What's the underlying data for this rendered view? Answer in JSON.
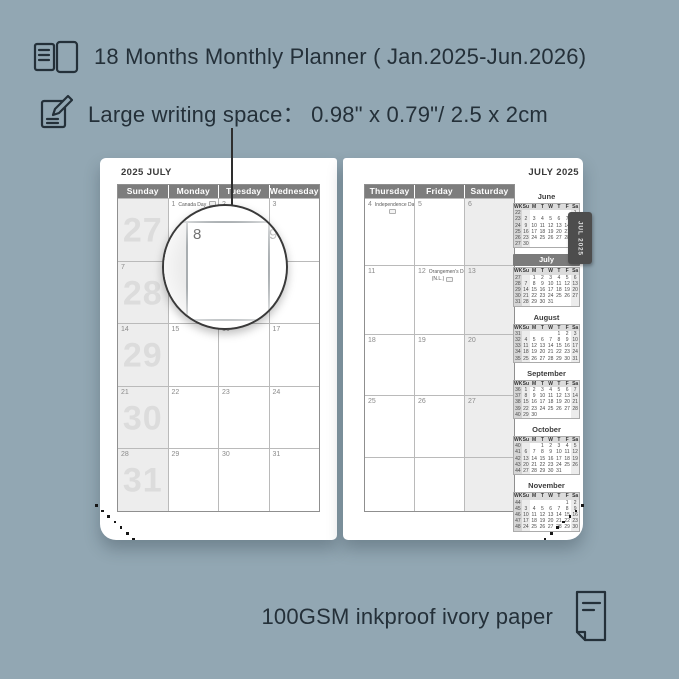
{
  "background_color": "#92a7b3",
  "text_color": "#243039",
  "accent_gray": "#7d7d7d",
  "features": {
    "months_line": "18 Months Monthly Planner ( Jan.2025-Jun.2026)",
    "writing_line": "Large writing space：  0.98\" x 0.79\"/ 2.5 x 2cm",
    "paper_line": "100GSM inkproof ivory paper"
  },
  "icons": {
    "months": "open-book-icon",
    "writing": "pencil-note-icon",
    "paper": "paper-sheet-icon"
  },
  "magnifier": {
    "cell_day": "8",
    "adjacent_day": "9"
  },
  "spread": {
    "left_page": {
      "title": "2025 JULY",
      "day_headers": [
        "Sunday",
        "Monday",
        "Tuesday",
        "Wednesday"
      ],
      "weeks": [
        {
          "week_number": "27",
          "cells": [
            {
              "date": ""
            },
            {
              "date": "1",
              "holiday": "Canada Day",
              "flag_line": 1
            },
            {
              "date": "2"
            },
            {
              "date": "3"
            }
          ]
        },
        {
          "week_number": "28",
          "cells": [
            {
              "date": "7"
            },
            {
              "date": "8"
            },
            {
              "date": "9"
            },
            {
              "date": "10"
            }
          ]
        },
        {
          "week_number": "29",
          "cells": [
            {
              "date": "14"
            },
            {
              "date": "15"
            },
            {
              "date": "16"
            },
            {
              "date": "17"
            }
          ]
        },
        {
          "week_number": "30",
          "cells": [
            {
              "date": "21"
            },
            {
              "date": "22"
            },
            {
              "date": "23"
            },
            {
              "date": "24"
            }
          ]
        },
        {
          "week_number": "31",
          "cells": [
            {
              "date": "28"
            },
            {
              "date": "29"
            },
            {
              "date": "30"
            },
            {
              "date": "31"
            }
          ]
        }
      ]
    },
    "right_page": {
      "title": "JULY 2025",
      "tab_label": "JUL 2025",
      "day_headers": [
        "Thursday",
        "Friday",
        "Saturday"
      ],
      "weeks": [
        {
          "cells": [
            {
              "date": "4",
              "holiday": "Independence Day",
              "holiday_line2": "",
              "flag_line": 2
            },
            {
              "date": "5"
            },
            {
              "date": "6"
            }
          ]
        },
        {
          "cells": [
            {
              "date": "11"
            },
            {
              "date": "12",
              "holiday": "Orangemen's Day",
              "holiday_line2": "(N.L.)",
              "flag_line": 2
            },
            {
              "date": "13"
            }
          ]
        },
        {
          "cells": [
            {
              "date": "18"
            },
            {
              "date": "19"
            },
            {
              "date": "20"
            }
          ]
        },
        {
          "cells": [
            {
              "date": "25"
            },
            {
              "date": "26"
            },
            {
              "date": "27"
            }
          ]
        },
        {
          "cells": [
            {
              "date": ""
            },
            {
              "date": ""
            },
            {
              "date": ""
            }
          ]
        }
      ]
    },
    "mini_calendars": {
      "weekday_header": [
        "WK",
        "Su",
        "M",
        "T",
        "W",
        "T",
        "F",
        "Sa"
      ],
      "months": [
        {
          "name": "June",
          "highlighted": false,
          "rows": [
            [
              "22",
              "",
              "",
              "",
              "",
              "",
              "",
              "1"
            ],
            [
              "23",
              "2",
              "3",
              "4",
              "5",
              "6",
              "7",
              "8"
            ],
            [
              "24",
              "9",
              "10",
              "11",
              "12",
              "13",
              "14",
              "15"
            ],
            [
              "25",
              "16",
              "17",
              "18",
              "19",
              "20",
              "21",
              "22"
            ],
            [
              "26",
              "23",
              "24",
              "25",
              "26",
              "27",
              "28",
              "29"
            ],
            [
              "27",
              "30",
              "",
              "",
              "",
              "",
              "",
              ""
            ]
          ]
        },
        {
          "name": "July",
          "highlighted": true,
          "rows": [
            [
              "27",
              "",
              "1",
              "2",
              "3",
              "4",
              "5",
              "6"
            ],
            [
              "28",
              "7",
              "8",
              "9",
              "10",
              "11",
              "12",
              "13"
            ],
            [
              "29",
              "14",
              "15",
              "16",
              "17",
              "18",
              "19",
              "20"
            ],
            [
              "30",
              "21",
              "22",
              "23",
              "24",
              "25",
              "26",
              "27"
            ],
            [
              "31",
              "28",
              "29",
              "30",
              "31",
              "",
              "",
              ""
            ]
          ]
        },
        {
          "name": "August",
          "highlighted": false,
          "rows": [
            [
              "31",
              "",
              "",
              "",
              "",
              "1",
              "2",
              "3"
            ],
            [
              "32",
              "4",
              "5",
              "6",
              "7",
              "8",
              "9",
              "10"
            ],
            [
              "33",
              "11",
              "12",
              "13",
              "14",
              "15",
              "16",
              "17"
            ],
            [
              "34",
              "18",
              "19",
              "20",
              "21",
              "22",
              "23",
              "24"
            ],
            [
              "35",
              "25",
              "26",
              "27",
              "28",
              "29",
              "30",
              "31"
            ]
          ]
        },
        {
          "name": "September",
          "highlighted": false,
          "rows": [
            [
              "36",
              "1",
              "2",
              "3",
              "4",
              "5",
              "6",
              "7"
            ],
            [
              "37",
              "8",
              "9",
              "10",
              "11",
              "12",
              "13",
              "14"
            ],
            [
              "38",
              "15",
              "16",
              "17",
              "18",
              "19",
              "20",
              "21"
            ],
            [
              "39",
              "22",
              "23",
              "24",
              "25",
              "26",
              "27",
              "28"
            ],
            [
              "40",
              "29",
              "30",
              "",
              "",
              "",
              "",
              ""
            ]
          ]
        },
        {
          "name": "October",
          "highlighted": false,
          "rows": [
            [
              "40",
              "",
              "",
              "1",
              "2",
              "3",
              "4",
              "5"
            ],
            [
              "41",
              "6",
              "7",
              "8",
              "9",
              "10",
              "11",
              "12"
            ],
            [
              "42",
              "13",
              "14",
              "15",
              "16",
              "17",
              "18",
              "19"
            ],
            [
              "43",
              "20",
              "21",
              "22",
              "23",
              "24",
              "25",
              "26"
            ],
            [
              "44",
              "27",
              "28",
              "29",
              "30",
              "31",
              "",
              ""
            ]
          ]
        },
        {
          "name": "November",
          "highlighted": false,
          "rows": [
            [
              "44",
              "",
              "",
              "",
              "",
              "",
              "1",
              "2"
            ],
            [
              "45",
              "3",
              "4",
              "5",
              "6",
              "7",
              "8",
              "9"
            ],
            [
              "46",
              "10",
              "11",
              "12",
              "13",
              "14",
              "15",
              "16"
            ],
            [
              "47",
              "17",
              "18",
              "19",
              "20",
              "21",
              "22",
              "23"
            ],
            [
              "48",
              "24",
              "25",
              "26",
              "27",
              "28",
              "29",
              "30"
            ]
          ]
        }
      ]
    }
  }
}
